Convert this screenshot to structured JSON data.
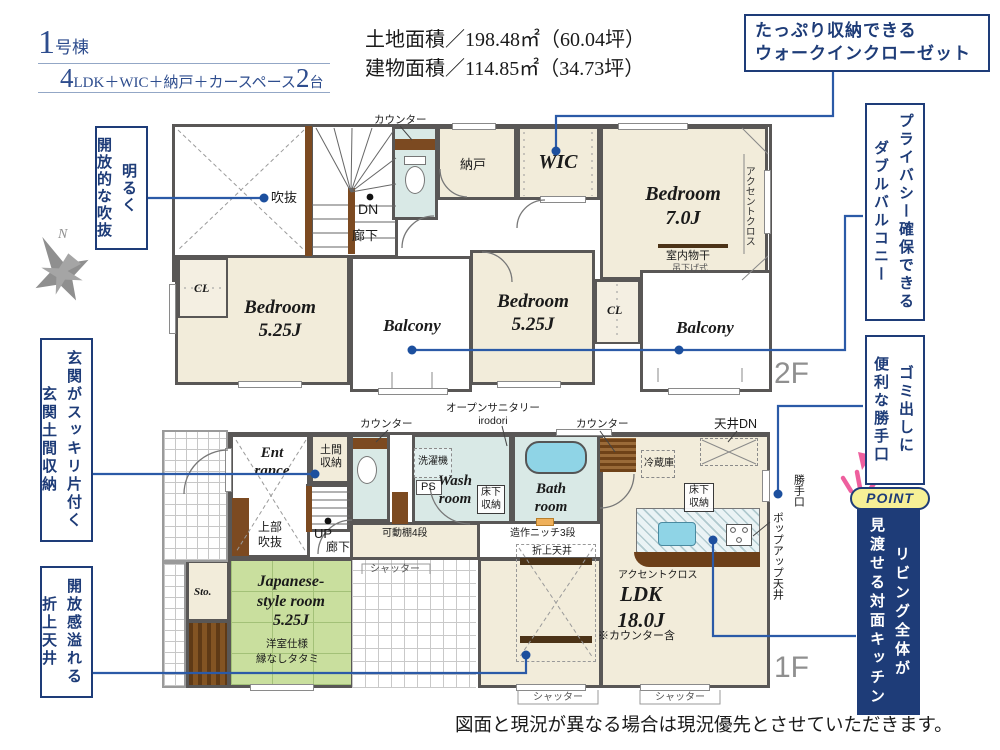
{
  "header": {
    "building_no": "1",
    "building_unit": "号棟",
    "layout_big1": "4",
    "layout_text": "LDK＋WIC＋納戸＋カースペース",
    "layout_big2": "2",
    "layout_unit": "台",
    "land_area_label": "土地面積／198.48㎡（60.04坪）",
    "building_area_label": "建物面積／114.85㎡（34.73坪）"
  },
  "callouts": {
    "wic_line1": "たっぷり収納できる",
    "wic_line2": "ウォークインクローゼット",
    "balcony_col1": "プライバシー確保できる",
    "balcony_col2": "ダブルバルコニー",
    "katteguchi_col1": "ゴミ出しに",
    "katteguchi_col2": "便利な勝手口",
    "point_badge": "POINT",
    "point_col1": "リビング全体が",
    "point_col2": "見渡せる対面キッチン",
    "void_col1": "明るく",
    "void_col2": "開放的な吹抜",
    "genkan_col1": "玄関がスッキリ片付く",
    "genkan_col2": "玄関土間収納",
    "ceiling_col1": "開放感溢れる",
    "ceiling_col2": "折上天井"
  },
  "compass_n": "N",
  "floor2": {
    "floor_label": "2F",
    "counter": "カウンター",
    "void_label": "吹抜",
    "dn": "DN",
    "hallway": "廊下",
    "nando": "納戸",
    "wic": "WIC",
    "bedroom1_name": "Bedroom",
    "bedroom1_size": "7.0J",
    "accent_cloth": "アクセントクロス",
    "indoor_drying": "室内物干",
    "hanging_type": "吊下げ式",
    "cl": "CL",
    "bedroom2_name": "Bedroom",
    "bedroom2_size": "5.25J",
    "balcony": "Balcony",
    "bedroom3_name": "Bedroom",
    "bedroom3_size": "5.25J"
  },
  "floor1": {
    "floor_label": "1F",
    "counter": "カウンター",
    "open_sanitary1": "オープンサニタリー",
    "open_sanitary2": "irodori",
    "ceiling_dn": "天井DN",
    "entrance1": "Ent",
    "entrance2": "rance",
    "doma1": "土間",
    "doma2": "収納",
    "washer": "洗濯機",
    "ps": "PS",
    "wash1": "Wash",
    "wash2": "room",
    "underfloor1": "床下",
    "underfloor2": "収納",
    "bath1": "Bath",
    "bath2": "room",
    "fridge": "冷蔵庫",
    "up": "UP",
    "hallway": "廊下",
    "shelf": "可動棚4段",
    "upper_void1": "上部",
    "upper_void2": "吹抜",
    "niche": "造作ニッチ3段",
    "oriage": "折上天井",
    "katteguchi": "勝手口",
    "popup_ceiling": "ポップアップ天井",
    "accent_cloth": "アクセントクロス",
    "ldk_name": "LDK",
    "ldk_size": "18.0J",
    "ldk_note": "※カウンター含",
    "sto": "Sto.",
    "jroom1": "Japanese-",
    "jroom2": "style room",
    "jroom3": "5.25J",
    "jroom_note1": "洋室仕様",
    "jroom_note2": "縁なしタタミ",
    "shutter": "シャッター"
  },
  "disclaimer": "図面と現況が異なる場合は現況優先とさせていただきます。"
}
